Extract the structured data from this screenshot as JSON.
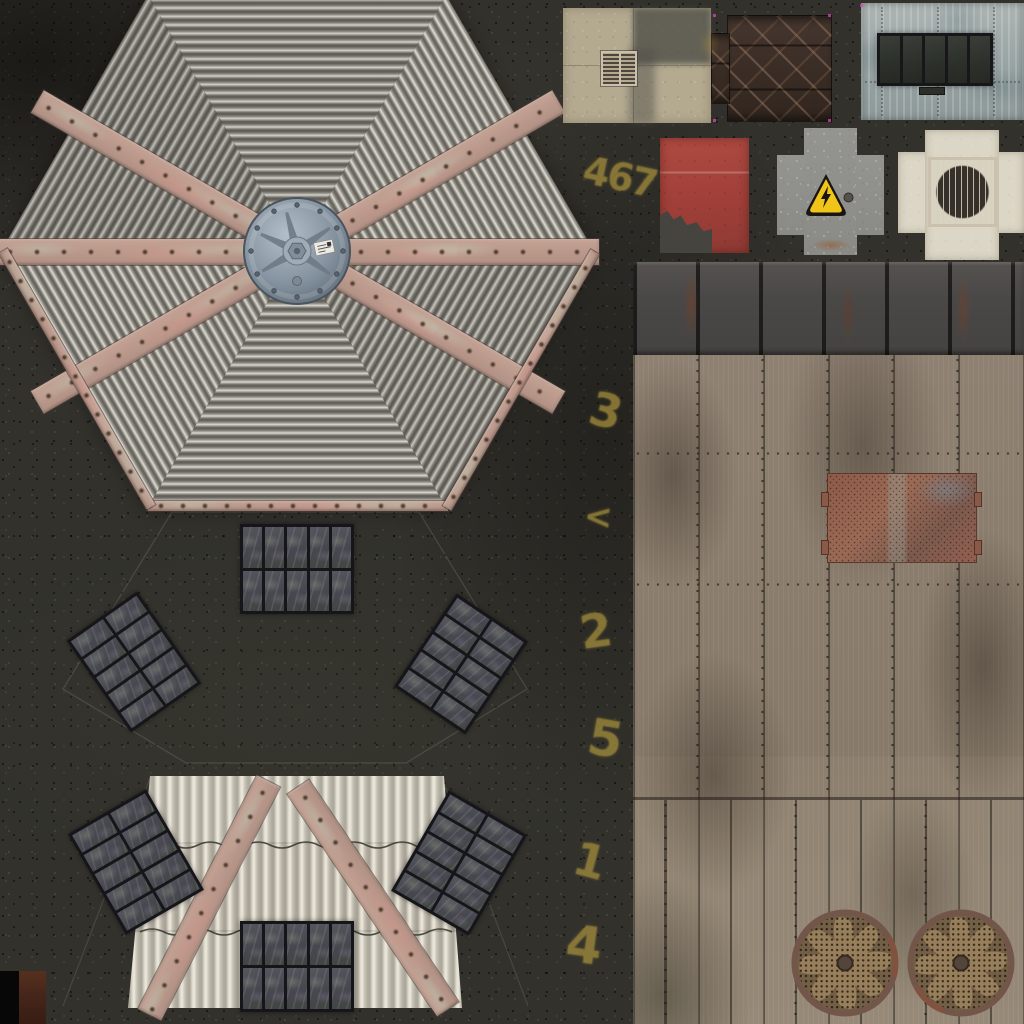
{
  "atlas": {
    "title": "Rooftop texture atlas",
    "spray_marks": {
      "m467": "467",
      "m3": "3",
      "mchev": "<",
      "m2": "2",
      "m5": "5",
      "m1": "1",
      "m4": "4"
    },
    "colors": {
      "ground": "#32312c",
      "roof_metal": "#b8b6ad",
      "strap": "#c0998c",
      "hub": "#8695a3",
      "roof_light": "#d9d4c7",
      "wood": "#8d7f6e",
      "metal_strip": "#4b4947",
      "mesh_panel": "#96604f",
      "red_panel": "#a5423c",
      "hazard_yellow": "#f0c419",
      "cream_tile": "#dcd6c6",
      "blue_panel": "#9aa5a8",
      "beige_tile": "#b4aa90",
      "diamond_plate": "#3a2e28",
      "solar_cell": "#4b4b52",
      "spray": "#9f8a3c"
    }
  }
}
